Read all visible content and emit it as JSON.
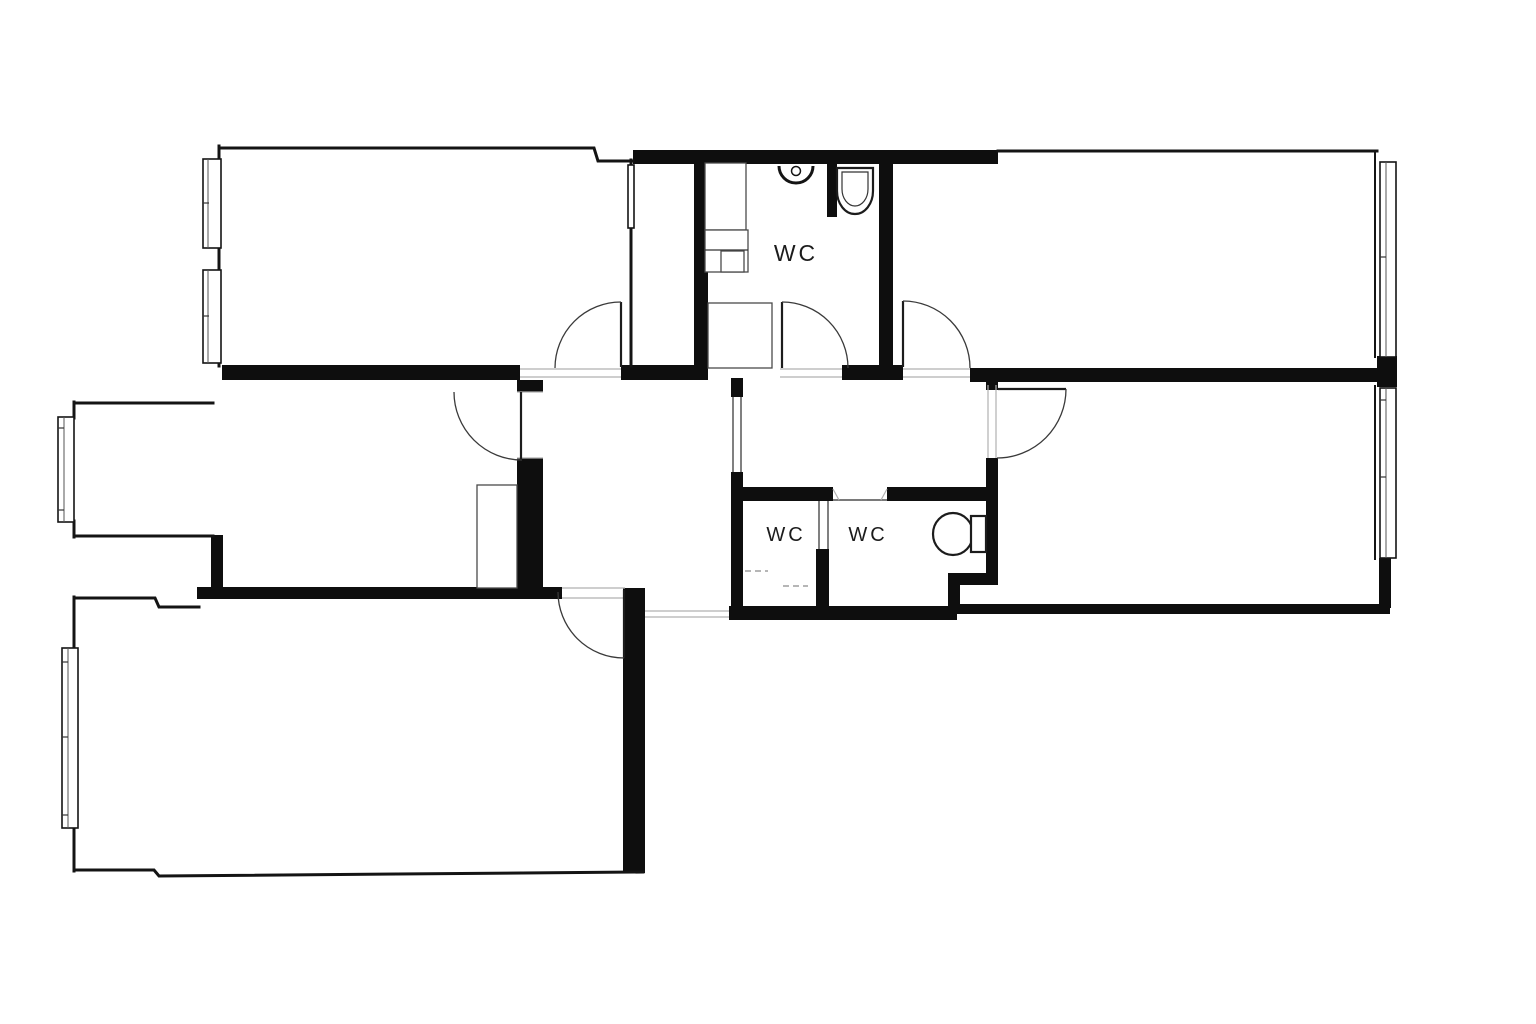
{
  "title": "apartment-floor-plan",
  "labels": {
    "wc_top": "WC",
    "wc_bottom_left": "WC",
    "wc_bottom_right": "WC"
  },
  "colors": {
    "background": "#ffffff",
    "walls": "#0e0e0e",
    "lines": "#3a3a3a"
  }
}
